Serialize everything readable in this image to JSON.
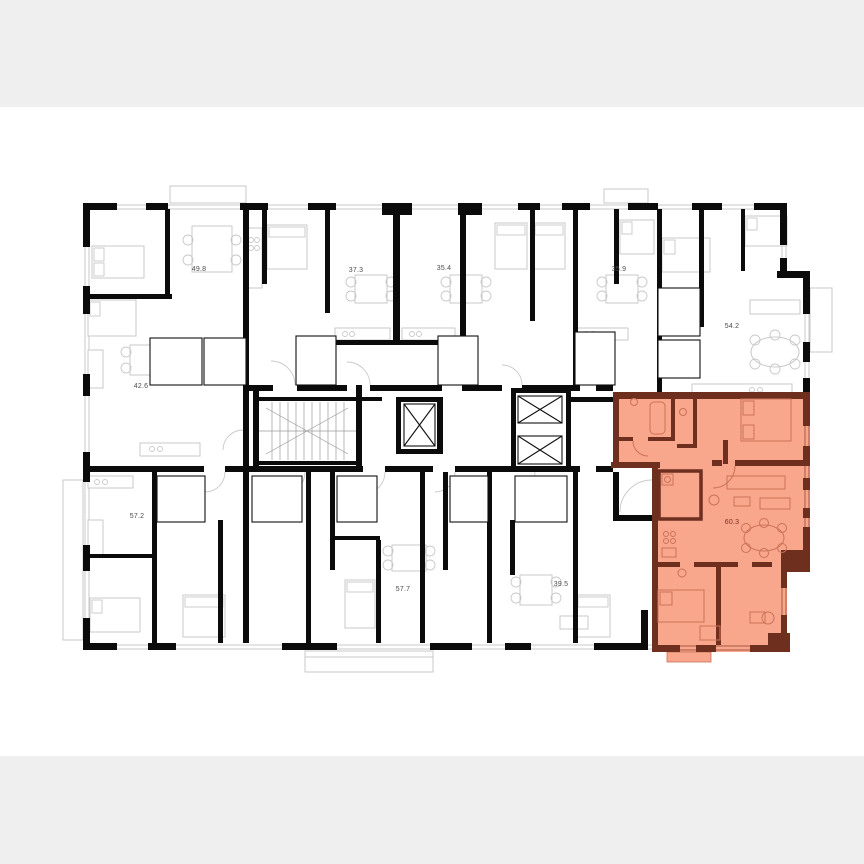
{
  "page": {
    "background": "#ffffff",
    "letterbox_band_color": "#efefef",
    "content_type": "residential floor plan image"
  },
  "floor_plan": {
    "kind": "apartment-building-floor-plan",
    "colors": {
      "walls": "#0b0b0b",
      "fixtures": "#c9c9c9",
      "highlight_fill": "#f8a68c",
      "highlight_wall": "#6e2f1f",
      "highlight_fixtures": "#cb7258",
      "label": "#4c4c4c",
      "highlight_label": "#7a3222"
    },
    "units": [
      {
        "id": "unit-49-8",
        "area": "49.8",
        "highlighted": false
      },
      {
        "id": "unit-37-3",
        "area": "37.3",
        "highlighted": false
      },
      {
        "id": "unit-35-4",
        "area": "35.4",
        "highlighted": false
      },
      {
        "id": "unit-35-9",
        "area": "35.9",
        "highlighted": false
      },
      {
        "id": "unit-54-2",
        "area": "54.2",
        "highlighted": false
      },
      {
        "id": "unit-42-6",
        "area": "42.6",
        "highlighted": false
      },
      {
        "id": "unit-57-2",
        "area": "57.2",
        "highlighted": false
      },
      {
        "id": "unit-57-7",
        "area": "57.7",
        "highlighted": false
      },
      {
        "id": "unit-39-5",
        "area": "39.5",
        "highlighted": false
      },
      {
        "id": "unit-60-3",
        "area": "60.3",
        "highlighted": true
      }
    ]
  }
}
